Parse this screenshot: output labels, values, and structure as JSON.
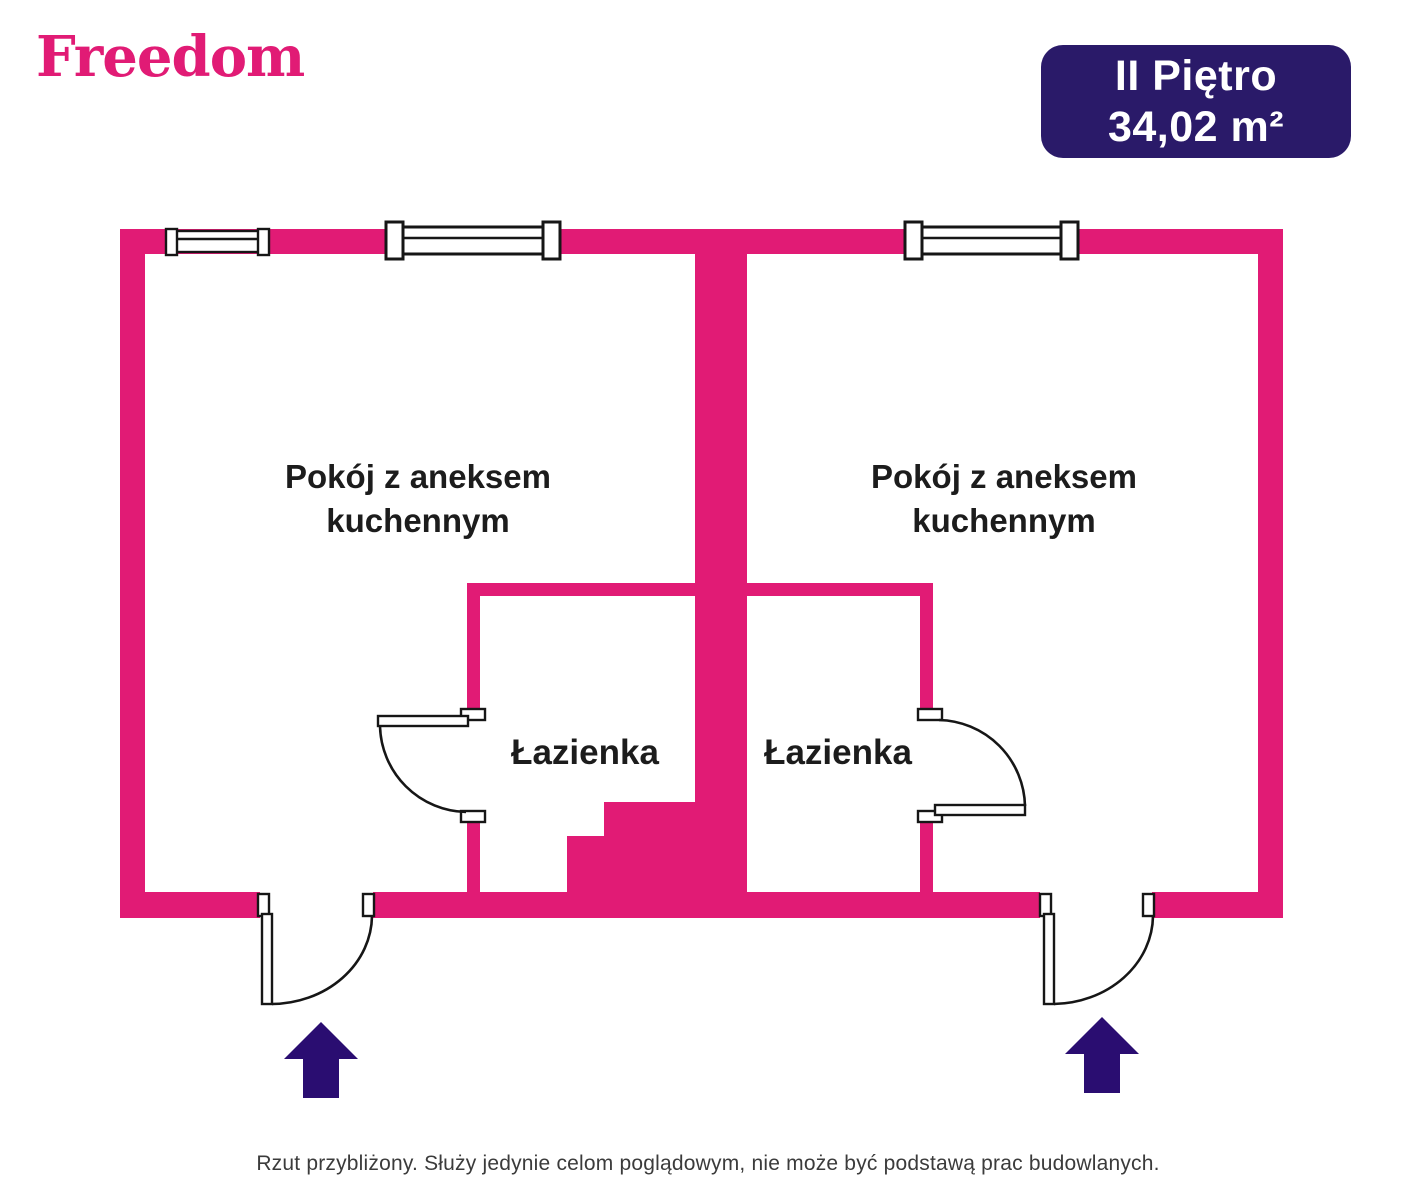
{
  "colors": {
    "wall": "#e11b75",
    "navy": "#2a0d71",
    "badge-bg": "#2a1a69",
    "ink": "#161616",
    "label": "#1c1c1c",
    "footer": "#3b3b3b"
  },
  "header": {
    "logo_text": "Freedom",
    "badge": {
      "floor_label": "II Piętro",
      "area_label": "34,02 m²"
    }
  },
  "floorplan": {
    "unit_left": {
      "room_label": "Pokój z aneksem kuchennym",
      "bathroom_label": "Łazienka"
    },
    "unit_right": {
      "room_label": "Pokój z aneksem kuchennym",
      "bathroom_label": "Łazienka"
    },
    "icons": {
      "entrance_left": "arrow-up",
      "entrance_right": "arrow-up"
    }
  },
  "footer": {
    "disclaimer": "Rzut przybliżony. Służy jedynie celom poglądowym, nie może być podstawą prac budowlanych."
  }
}
